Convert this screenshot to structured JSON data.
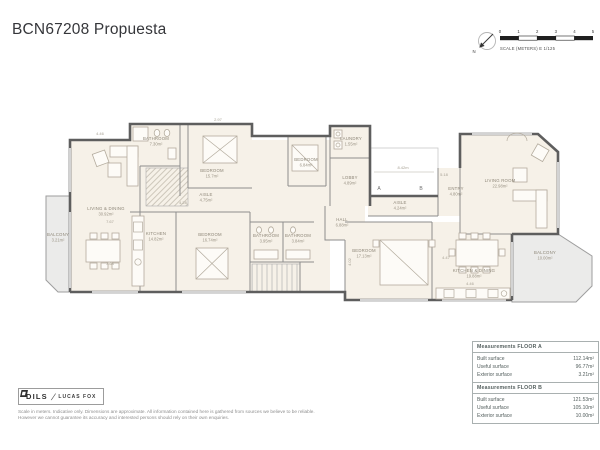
{
  "title": "BCN67208 Propuesta",
  "compass": {
    "north_label": "N"
  },
  "scale_bar": {
    "ticks": [
      "0",
      "1",
      "2",
      "3",
      "4",
      "5"
    ],
    "caption": "SCALE (METERS) E 1/125"
  },
  "plan": {
    "rooms": {
      "balcony_a": {
        "name": "BALCONY",
        "area": "3.21m²"
      },
      "living_dining_a": {
        "name": "LIVING & DINING",
        "area": "30.92m²"
      },
      "bathroom_a1": {
        "name": "BATHROOM",
        "area": "7.30m²"
      },
      "bedroom_a1": {
        "name": "BEDROOM",
        "area": "15.7m²"
      },
      "aisle_a": {
        "name": "AISLE",
        "area": "4.75m²"
      },
      "kitchen_a": {
        "name": "KITCHEN",
        "area": "14.82m²"
      },
      "bedroom_a2": {
        "name": "BEDROOM",
        "area": "16.74m²"
      },
      "bathroom_a2": {
        "name": "BATHROOM",
        "area": "3.95m²"
      },
      "bathroom_a3": {
        "name": "BATHROOM",
        "area": "3.84m²"
      },
      "bedroom_a3": {
        "name": "BEDROOM",
        "area": "6.84m²"
      },
      "laundry": {
        "name": "LAUNDRY",
        "area": "1.55m²"
      },
      "lobby": {
        "name": "LOBBY",
        "area": "4.89m²"
      },
      "entry_b": {
        "name": "ENTRY",
        "area": "4.80m²"
      },
      "living_b": {
        "name": "LIVING ROOM",
        "area": "22.98m²"
      },
      "aisle_b": {
        "name": "AISLE",
        "area": "4.24m²"
      },
      "hall_b": {
        "name": "HALL",
        "area": "6.88m²"
      },
      "bedroom_b": {
        "name": "BEDROOM",
        "area": "17.13m²"
      },
      "kitchen_dining_b": {
        "name": "KITCHEN & DINING",
        "area": "19.88m²"
      },
      "balcony_b": {
        "name": "BALCONY",
        "area": "10.00m²"
      }
    },
    "unit_markers": {
      "a": "A",
      "b": "B"
    },
    "dimensions": {
      "d0": "4.46",
      "d1": "2.97",
      "d2": "7.67",
      "d3": "3.68",
      "d4": "4.28",
      "d5": "8.42m",
      "d6": "5.18",
      "d7": "4.47",
      "d8": "4.46",
      "d9": "4.02"
    }
  },
  "measurements": {
    "floor_a": {
      "title": "Measurements FLOOR A",
      "rows": [
        {
          "label": "Built surface",
          "value": "112.14m²"
        },
        {
          "label": "Useful surface",
          "value": "96.77m²"
        },
        {
          "label": "Exterior surface",
          "value": "3.21m²"
        }
      ]
    },
    "floor_b": {
      "title": "Measurements FLOOR B",
      "rows": [
        {
          "label": "Built surface",
          "value": "121.53m²"
        },
        {
          "label": "Useful surface",
          "value": "105.10m²"
        },
        {
          "label": "Exterior surface",
          "value": "10.00m²"
        }
      ]
    }
  },
  "footer": {
    "logo_brand": "DILS",
    "logo_partner": "LUCAS FOX",
    "disclaimer_line1": "Scale in meters. Indicative only. Dimensions are approximate. All information contained here is gathered from sources we believe to be reliable.",
    "disclaimer_line2": "However we cannot guarantee its accuracy and interested persons should rely on their own enquiries."
  }
}
